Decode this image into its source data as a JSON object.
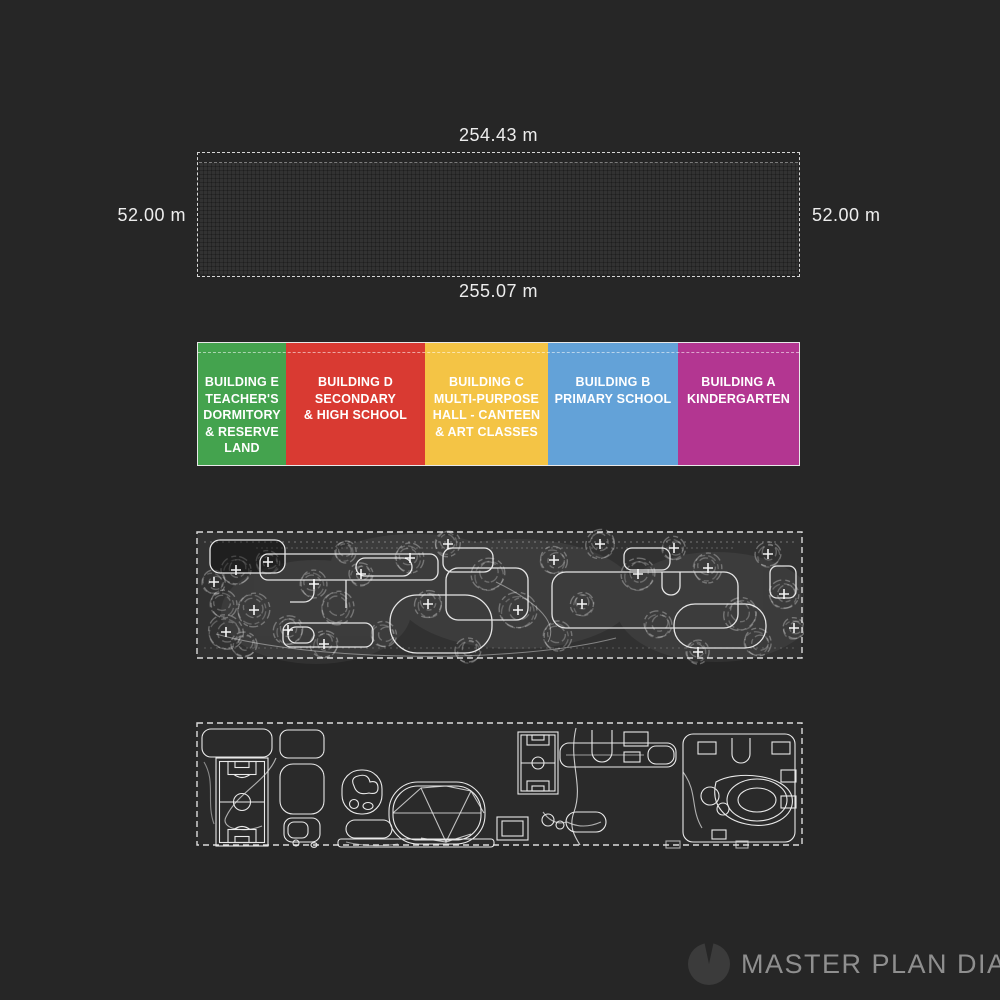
{
  "page": {
    "background": "#262626"
  },
  "site_plan": {
    "top_dimension": "254.43 m",
    "left_dimension": "52.00 m",
    "right_dimension": "52.00 m",
    "bottom_dimension": "255.07 m"
  },
  "legend": {
    "segments": [
      {
        "id": "building-e",
        "color": "#44a34e",
        "width_px": 88,
        "label_lines": [
          "BUILDING E",
          "TEACHER'S",
          "DORMITORY",
          "& RESERVE",
          "LAND"
        ]
      },
      {
        "id": "building-d",
        "color": "#d93a32",
        "width_px": 139,
        "label_lines": [
          "BUILDING D",
          "SECONDARY",
          "& HIGH SCHOOL"
        ]
      },
      {
        "id": "building-c",
        "color": "#f4c445",
        "width_px": 123,
        "label_lines": [
          "BUILDING C",
          "MULTI-PURPOSE",
          "HALL - CANTEEN",
          "& ART CLASSES"
        ]
      },
      {
        "id": "building-b",
        "color": "#63a2d8",
        "width_px": 130,
        "label_lines": [
          "BUILDING B",
          "PRIMARY SCHOOL"
        ]
      },
      {
        "id": "building-a",
        "color": "#b33691",
        "width_px": 121,
        "label_lines": [
          "BUILDING A",
          "KINDERGARTEN"
        ]
      }
    ]
  },
  "footer": {
    "label": "MASTER PLAN DIAGRAM",
    "icon": "clock-logo-icon",
    "text_color": "#8f8f8f"
  }
}
